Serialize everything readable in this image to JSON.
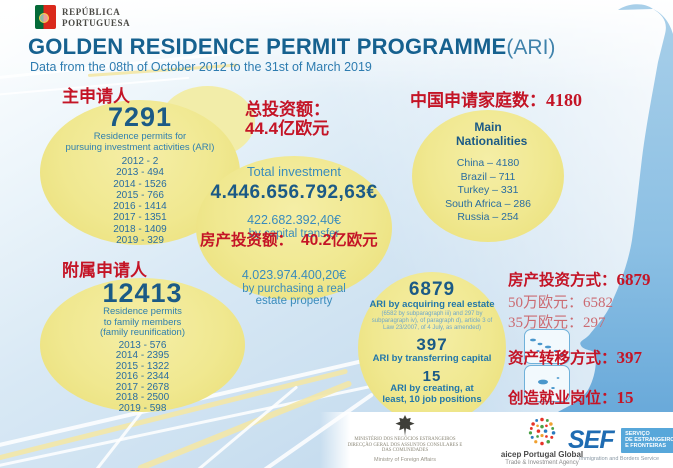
{
  "colors": {
    "accent_red": "#c41426",
    "faded_red": "#cb6b72",
    "title_blue": "#16618f",
    "subtitle_blue": "#2e7cb0",
    "number_blue": "#1b5a86",
    "circle_yellow": "#f0e890",
    "map_blue": "#8ec3e6"
  },
  "header": {
    "emblem_line1": "REPÚBLICA",
    "emblem_line2": "PORTUGUESA",
    "title": "GOLDEN RESIDENCE PERMIT PROGRAMME",
    "title_suffix": "(ARI)",
    "subtitle": "Data from the 08th of October 2012 to the 31st of March 2019"
  },
  "main_applicants": {
    "label_zh": "主申请人",
    "total": "7291",
    "desc_line1": "Residence permits for",
    "desc_line2": "pursuing investment activities (ARI)",
    "by_year": [
      "2012 - 2",
      "2013 - 494",
      "2014 - 1526",
      "2015 - 766",
      "2016 - 1414",
      "2017 - 1351",
      "2018 - 1409",
      "2019 - 329"
    ]
  },
  "family_applicants": {
    "label_zh": "附属申请人",
    "total": "12413",
    "desc_line1": "Residence permits",
    "desc_line2": "to family members",
    "desc_line3": "(family reunification)",
    "by_year": [
      "2013 - 576",
      "2014 - 2395",
      "2015 - 1322",
      "2016 - 2344",
      "2017 - 2678",
      "2018 - 2500",
      "2019 - 598"
    ]
  },
  "investment": {
    "zh_total_label": "总投资额：",
    "zh_total_value": "44.4亿欧元",
    "total_label": "Total investment",
    "total_value": "4.446.656.792,63€",
    "capital_value": "422.682.392,40€",
    "capital_label": "by capital transfer",
    "zh_realestate_label": "房产投资额：",
    "zh_realestate_value": "40.2亿欧元",
    "realestate_value": "4.023.974.400,20€",
    "realestate_label": "by purchasing a real estate property"
  },
  "nationalities": {
    "zh_header_label": "中国申请家庭数：",
    "zh_header_value": "4180",
    "title": "Main Nationalities",
    "items": [
      "China – 4180",
      "Brazil –  711",
      "Turkey – 331",
      "South Africa – 286",
      "Russia – 254"
    ]
  },
  "ari_types": {
    "realestate_count": "6879",
    "realestate_label": "ARI by acquiring real estate",
    "realestate_note": "(6582 by subparagraph iii) and 297 by subparagraph iv), of paragraph d), article 3 of Law 23/2007, of 4 July, as amended)",
    "capital_count": "397",
    "capital_label": "ARI by transferring capital",
    "jobs_count": "15",
    "jobs_label": "ARI by creating, at least, 10 job positions"
  },
  "zh_summary": {
    "realestate_label": "房产投资方式：",
    "realestate_value": "6879",
    "eur500k_label": "50万欧元：",
    "eur500k_value": "6582",
    "eur350k_label": "35万欧元：",
    "eur350k_value": "297",
    "capital_label": "资产转移方式：",
    "capital_value": "397",
    "jobs_label": "创造就业岗位：",
    "jobs_value": "15"
  },
  "footer": {
    "ministry_line1": "MINISTÉRIO DOS NEGÓCIOS ESTRANGEIROS",
    "ministry_line2": "DIRECÇÃO GERAL DOS ASSUNTOS CONSULARES E",
    "ministry_line3": "DAS COMUNIDADES",
    "ministry_en": "Ministry of Foreign Affairs",
    "aicep_name": "aicep Portugal Global",
    "aicep_sub": "Trade & Investment Agency",
    "sef_name": "SEF",
    "sef_line1": "SERVIÇO",
    "sef_line2": "DE ESTRANGEIROS",
    "sef_line3": "E FRONTEIRAS",
    "sef_sub": "Immigration and Borders Service"
  }
}
